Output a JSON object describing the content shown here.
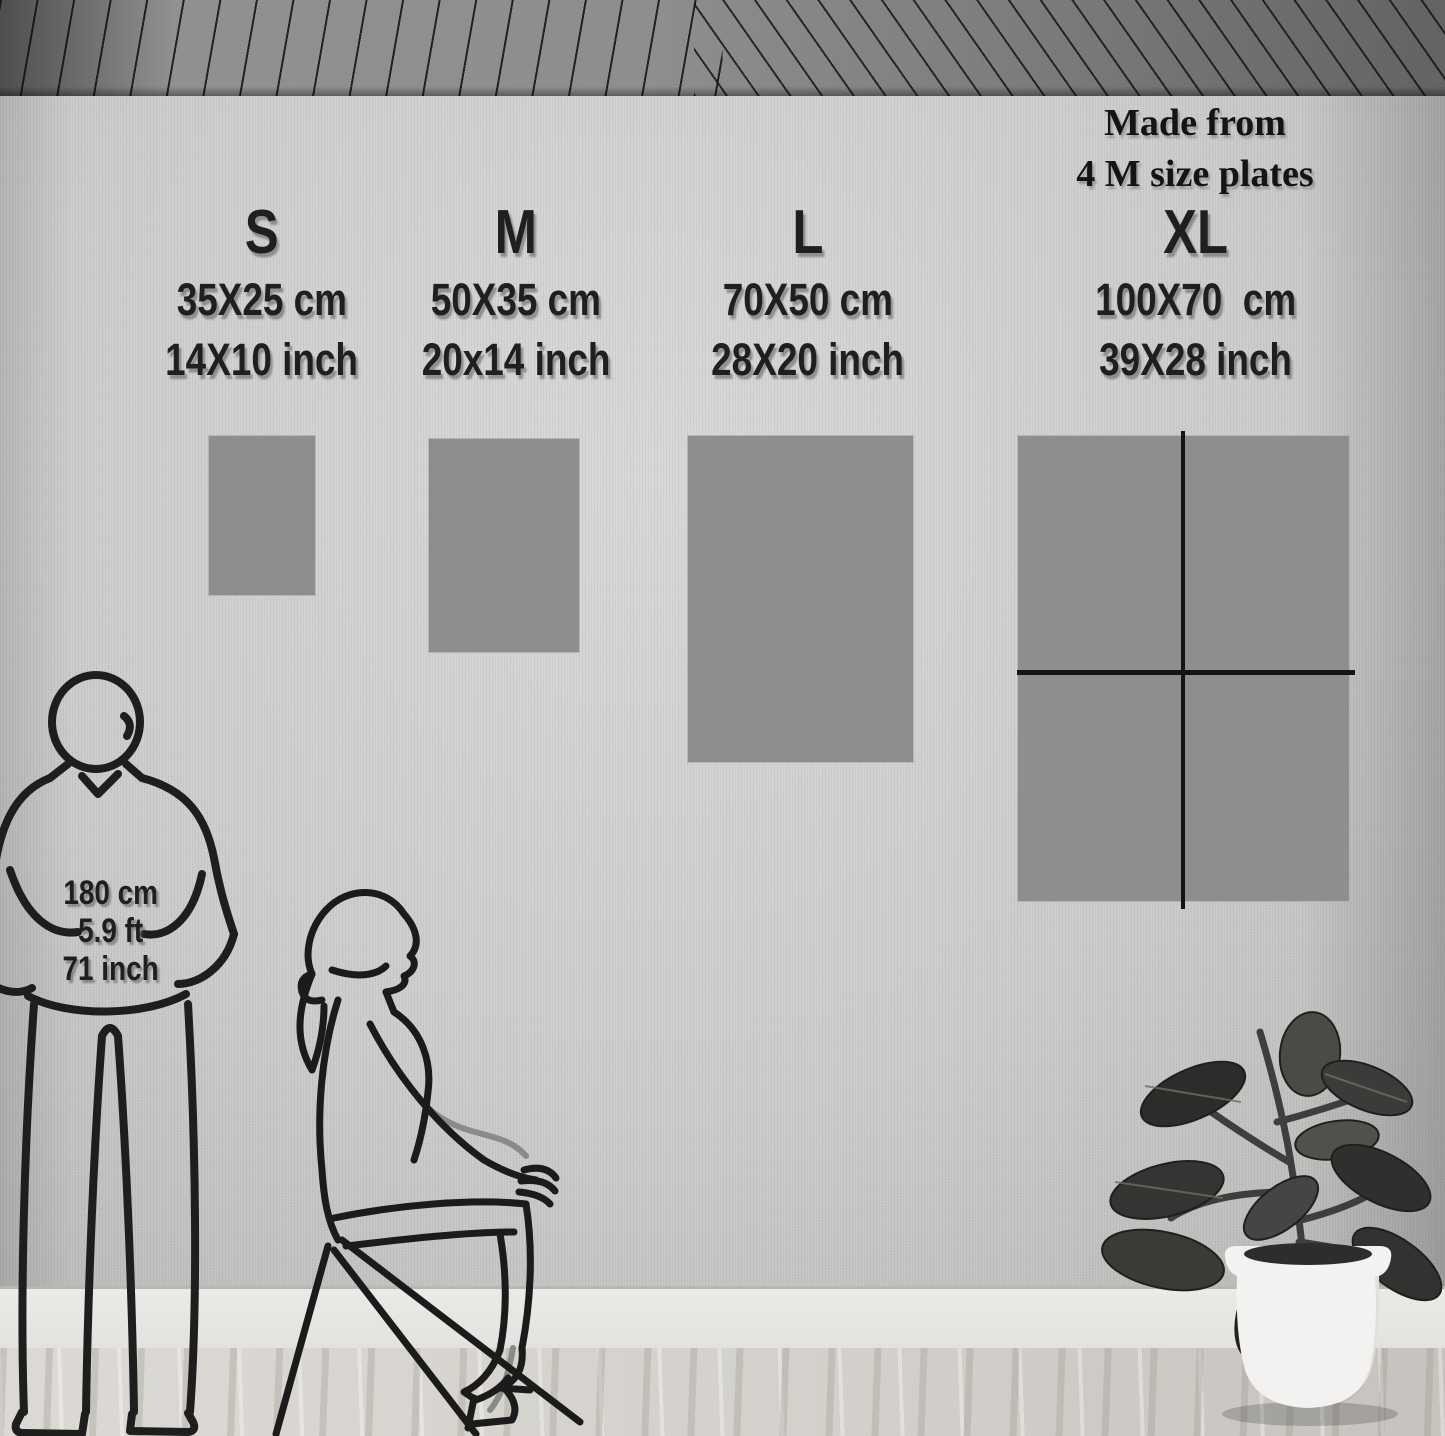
{
  "note": {
    "line1": "Made from",
    "line2": "4 M size plates"
  },
  "sizes": [
    {
      "label": "S",
      "cm": "35X25 cm",
      "inch": "14X10 inch"
    },
    {
      "label": "M",
      "cm": "50X35 cm",
      "inch": "20x14 inch"
    },
    {
      "label": "L",
      "cm": "70X50 cm",
      "inch": "28X20 inch"
    },
    {
      "label": "XL",
      "cm": "100X70  cm",
      "inch": "39X28 inch"
    }
  ],
  "reference_person": {
    "height_cm": "180 cm",
    "height_ft": "5.9 ft",
    "height_inch": "71 inch"
  },
  "colors": {
    "poster_gray": "#8e8e8c",
    "wall_gray": "#cccccа",
    "text_dark": "#1f1f1f",
    "divider_black": "#141414",
    "pot_white": "#f3f2f0"
  }
}
